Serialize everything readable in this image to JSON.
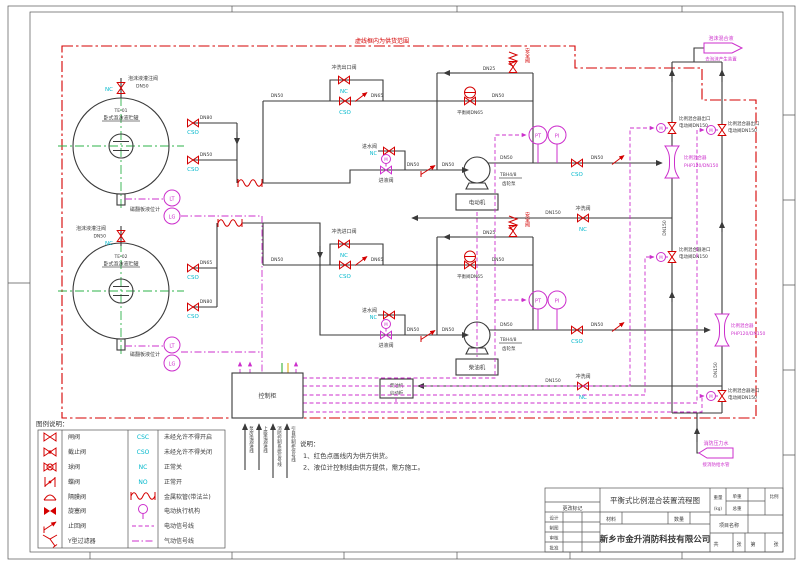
{
  "labels": {
    "scope": "虚线框内为供货范围",
    "fill_valve": "泡沫液灌注阀",
    "dn25": "DN25",
    "dn50": "DN50",
    "dn65": "DN65",
    "dn80": "DN80",
    "dn150": "DN150",
    "tank1_id": "TE-01",
    "tank1_name": "卧式泡沫液贮罐",
    "tank2_id": "TE-02",
    "tank2_name": "卧式泡沫液贮罐",
    "level_gauge": "磁翻板液位计",
    "lt": "LT",
    "lg": "LG",
    "pt": "PT",
    "pi": "PI",
    "nc": "NC",
    "cso": "CSO",
    "m": "M",
    "flush_outlet_valve": "冲洗出口阀",
    "flush_inlet_valve": "冲洗进口阀",
    "flush_valve": "冲洗阀",
    "water_inlet_valve": "进水阀",
    "liquid_inlet_valve": "进液阀",
    "pump_model": "TBH4/8",
    "pump_type": "齿轮泵",
    "motor": "电动机",
    "diesel": "柴油机",
    "diesel_starter1": "柴油机",
    "diesel_starter2": "启动柜",
    "safety_valve": "安全阀",
    "balance_valve": "平衡阀DN65",
    "mixer": "比例混合器",
    "mixer_model": "PHP120/DN150",
    "mixer_outlet1": "比例混合器出口",
    "mixer_outlet2": "电动阀DN150",
    "mixer_inlet1": "比例混合器进口",
    "mixer_inlet2": "电动阀DN150",
    "control_cabinet": "控制柜",
    "foam_out_top": "泡沫混合液",
    "foam_out_bottom": "去泡沫产生装置",
    "water_in_top": "消防压力水",
    "water_in_bottom": "接消防给水管",
    "cable1": "泵房电源进线",
    "cable2": "上级电源进线",
    "cable3": "消防控制系统信号线",
    "cable4": "引自控制柜信号线"
  },
  "legend": {
    "heading": "图例说明：",
    "col1": [
      {
        "label": "闸阀"
      },
      {
        "label": "截止阀"
      },
      {
        "label": "球阀"
      },
      {
        "label": "蝶阀"
      },
      {
        "label": "隔膜阀"
      },
      {
        "label": "旋塞阀"
      },
      {
        "label": "止回阀"
      },
      {
        "label": "Y型过滤器"
      }
    ],
    "col2": [
      {
        "code": "CSC",
        "label": "未经允许不得开启"
      },
      {
        "code": "CSO",
        "label": "未经允许不得关闭"
      },
      {
        "code": "NC",
        "label": "正常关"
      },
      {
        "code": "NO",
        "label": "正常开"
      },
      {
        "code": "",
        "label": "金属软管(带法兰)"
      },
      {
        "code": "",
        "label": "电动执行机构"
      },
      {
        "code": "",
        "label": "电动信号线"
      },
      {
        "code": "",
        "label": "气动信号线"
      }
    ]
  },
  "notes": {
    "heading": "说明：",
    "line1": "1、红色点画线内为供方供货。",
    "line2": "2、液位计控制线由供方提供，需方施工。"
  },
  "title_block": {
    "drawing_title": "平衡式比例混合装置流程图",
    "company": "新乡市金升消防科技有限公司",
    "change_mark": "更改标记",
    "design": "设计",
    "draft": "制图",
    "check": "审核",
    "approve": "批准",
    "material": "材料",
    "quantity": "数量",
    "weight": "重量",
    "weight_unit": "(kg)",
    "unit_weight": "单重",
    "total_weight": "总重",
    "scale": "比例",
    "project_name": "项目名称",
    "sheet_total": "共",
    "sheet_zhang": "张",
    "sheet_no": "第",
    "sheet_zhang2": "张"
  },
  "colors": {
    "pipe": "#3a3a3a",
    "valve_red": "#d40000",
    "state_cyan": "#00b8cc",
    "signal_magenta": "#cc2fcc",
    "centerline_green": "#2db34a"
  }
}
